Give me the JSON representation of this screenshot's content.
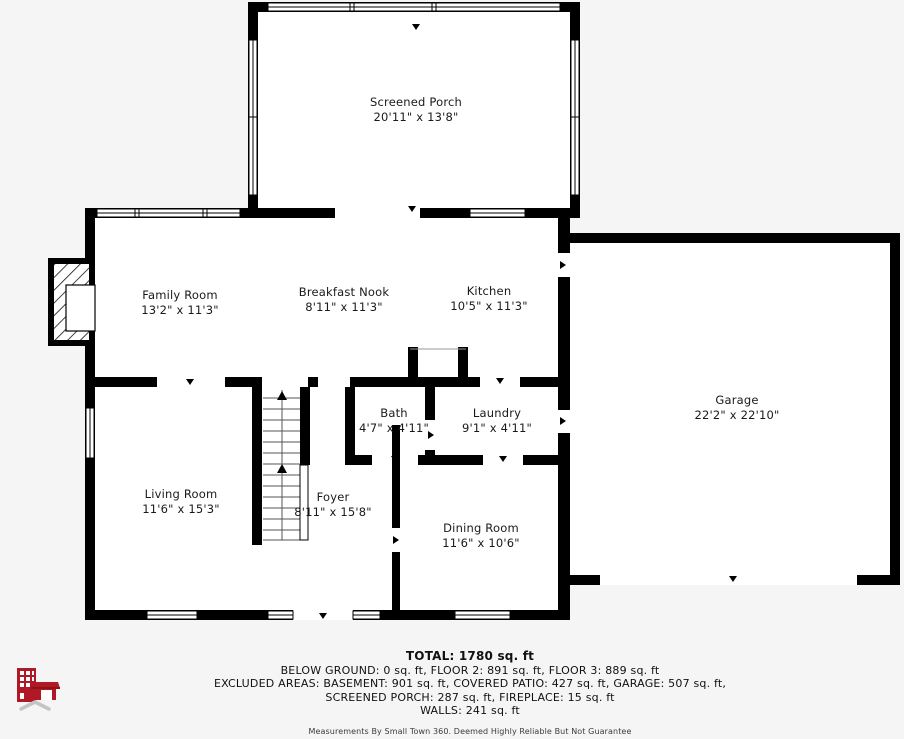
{
  "page": {
    "background_color": "#f5f5f5",
    "wall_color": "#000000",
    "room_fill_color": "#ffffff"
  },
  "rooms": [
    {
      "id": "screened-porch",
      "name": "Screened Porch",
      "dims": "20'11\" x 13'8\""
    },
    {
      "id": "family-room",
      "name": "Family Room",
      "dims": "13'2\" x 11'3\""
    },
    {
      "id": "breakfast-nook",
      "name": "Breakfast Nook",
      "dims": "8'11\" x 11'3\""
    },
    {
      "id": "kitchen",
      "name": "Kitchen",
      "dims": "10'5\" x 11'3\""
    },
    {
      "id": "garage",
      "name": "Garage",
      "dims": "22'2\" x 22'10\""
    },
    {
      "id": "bath",
      "name": "Bath",
      "dims": "4'7\" x 4'11\""
    },
    {
      "id": "laundry",
      "name": "Laundry",
      "dims": "9'1\" x 4'11\""
    },
    {
      "id": "living-room",
      "name": "Living Room",
      "dims": "11'6\" x 15'3\""
    },
    {
      "id": "foyer",
      "name": "Foyer",
      "dims": "8'11\" x 15'8\""
    },
    {
      "id": "dining-room",
      "name": "Dining Room",
      "dims": "11'6\" x 10'6\""
    }
  ],
  "footer": {
    "total": "TOTAL: 1780 sq. ft",
    "line2": "BELOW GROUND: 0 sq. ft, FLOOR 2: 891 sq. ft, FLOOR 3: 889 sq. ft",
    "line3": "EXCLUDED AREAS: BASEMENT: 901 sq. ft, COVERED PATIO: 427 sq. ft, GARAGE: 507 sq. ft,",
    "line4": "SCREENED PORCH: 287 sq. ft, FIREPLACE: 15 sq. ft",
    "line5": "WALLS: 241 sq. ft",
    "disclaimer": "Measurements By Small Town 360. Deemed Highly Reliable But Not Guarantee"
  },
  "logo": {
    "label": "small-town-360-logo",
    "building_color": "#b01826",
    "chevron_color": "#c4c4c4"
  }
}
